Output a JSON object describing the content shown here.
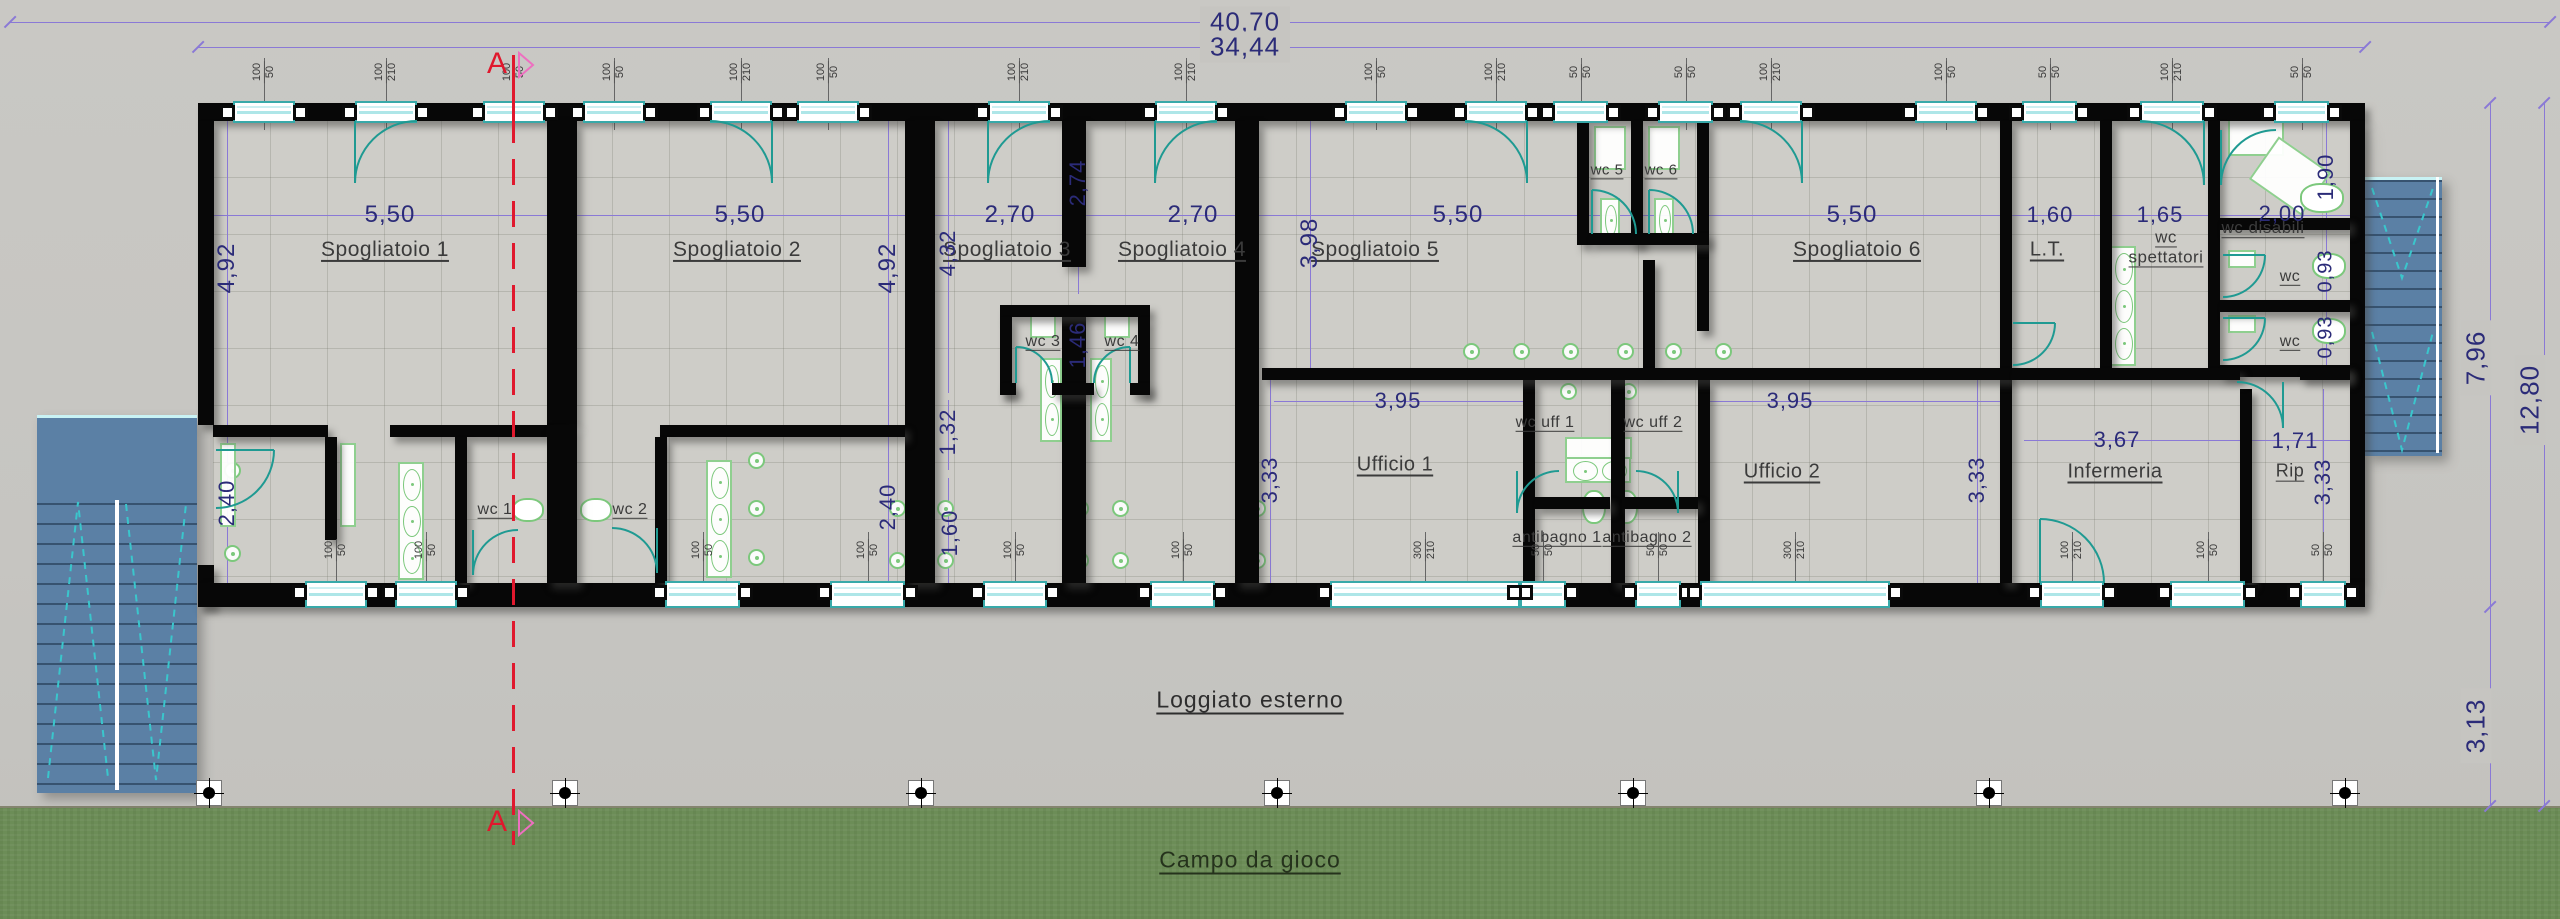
{
  "canvas": {
    "w": 2560,
    "h": 919
  },
  "palette": {
    "concrete": "#c6c5c1",
    "floor": "#cecdc8",
    "wall": "#070707",
    "dim_line": "#8a79d6",
    "dim_text": "#2b2b78",
    "window_frame": "#38a9a9",
    "door_teal": "#1f9a92",
    "fixture_green": "#7cc87c",
    "stair_blue": "#5b80a5",
    "grass": "#6c8d57",
    "section_red": "#e0182d",
    "flag_pink": "#ee6fc0"
  },
  "section": {
    "label": "A",
    "x": 513,
    "top_label_y": 64,
    "bottom_label_y": 822,
    "line_top": 55,
    "line_bottom": 845
  },
  "site": {
    "loggia_label": "Loggiato esterno",
    "loggia_x": 1250,
    "loggia_y": 700,
    "field_label": "Campo da gioco",
    "field_x": 1250,
    "field_y": 860,
    "grass_y": 806
  },
  "building": {
    "floor": [
      213,
      120,
      2139,
      463
    ]
  },
  "overall_dims": [
    {
      "t": "40,70",
      "x": 1245,
      "y": 22,
      "o": "h",
      "fs": 26,
      "bg": true
    },
    {
      "t": "34,44",
      "x": 1245,
      "y": 47,
      "o": "h",
      "fs": 26,
      "bg": true
    },
    {
      "t": "7,96",
      "x": 2476,
      "y": 358,
      "o": "v",
      "fs": 26,
      "bg": true
    },
    {
      "t": "12,80",
      "x": 2530,
      "y": 400,
      "o": "v",
      "fs": 26,
      "bg": true
    },
    {
      "t": "3,13",
      "x": 2476,
      "y": 726,
      "o": "v",
      "fs": 26,
      "bg": true
    }
  ],
  "dim_labels": [
    {
      "t": "5,50",
      "x": 390,
      "y": 215,
      "o": "h",
      "fs": 24
    },
    {
      "t": "5,50",
      "x": 740,
      "y": 215,
      "o": "h",
      "fs": 24
    },
    {
      "t": "2,70",
      "x": 1010,
      "y": 215,
      "o": "h",
      "fs": 24
    },
    {
      "t": "2,70",
      "x": 1193,
      "y": 215,
      "o": "h",
      "fs": 24
    },
    {
      "t": "5,50",
      "x": 1458,
      "y": 215,
      "o": "h",
      "fs": 24
    },
    {
      "t": "5,50",
      "x": 1852,
      "y": 215,
      "o": "h",
      "fs": 24
    },
    {
      "t": "1,60",
      "x": 2050,
      "y": 215,
      "o": "h",
      "fs": 22
    },
    {
      "t": "1,65",
      "x": 2160,
      "y": 215,
      "o": "h",
      "fs": 22
    },
    {
      "t": "2,00",
      "x": 2282,
      "y": 214,
      "o": "h",
      "fs": 22
    },
    {
      "t": "4,92",
      "x": 227,
      "y": 268,
      "o": "v",
      "fs": 24
    },
    {
      "t": "4,92",
      "x": 888,
      "y": 268,
      "o": "v",
      "fs": 24
    },
    {
      "t": "4,32",
      "x": 948,
      "y": 253,
      "o": "v",
      "fs": 22
    },
    {
      "t": "2,74",
      "x": 1078,
      "y": 183,
      "o": "v",
      "fs": 22
    },
    {
      "t": "1,46",
      "x": 1078,
      "y": 345,
      "o": "v",
      "fs": 22
    },
    {
      "t": "3,98",
      "x": 1310,
      "y": 243,
      "o": "v",
      "fs": 24
    },
    {
      "t": "1,90",
      "x": 2326,
      "y": 177,
      "o": "v",
      "fs": 22
    },
    {
      "t": "2,40",
      "x": 227,
      "y": 503,
      "o": "v",
      "fs": 22
    },
    {
      "t": "2,40",
      "x": 888,
      "y": 507,
      "o": "v",
      "fs": 22
    },
    {
      "t": "1,32",
      "x": 948,
      "y": 432,
      "o": "v",
      "fs": 22
    },
    {
      "t": "1,60",
      "x": 950,
      "y": 533,
      "o": "v",
      "fs": 22
    },
    {
      "t": "0,93",
      "x": 2326,
      "y": 271,
      "o": "v",
      "fs": 20
    },
    {
      "t": "0,93",
      "x": 2326,
      "y": 337,
      "o": "v",
      "fs": 20
    },
    {
      "t": "3,95",
      "x": 1398,
      "y": 401,
      "o": "h",
      "fs": 22
    },
    {
      "t": "3,95",
      "x": 1790,
      "y": 401,
      "o": "h",
      "fs": 22
    },
    {
      "t": "3,67",
      "x": 2117,
      "y": 440,
      "o": "h",
      "fs": 22
    },
    {
      "t": "1,71",
      "x": 2295,
      "y": 441,
      "o": "h",
      "fs": 22
    },
    {
      "t": "3,33",
      "x": 1270,
      "y": 480,
      "o": "v",
      "fs": 22
    },
    {
      "t": "3,33",
      "x": 1977,
      "y": 480,
      "o": "v",
      "fs": 22
    },
    {
      "t": "3,33",
      "x": 2323,
      "y": 482,
      "o": "v",
      "fs": 22
    }
  ],
  "dim_lines": [
    [
      10,
      22,
      2540,
      1
    ],
    [
      198,
      47,
      2167,
      1
    ],
    [
      213,
      215,
      2139,
      1
    ],
    [
      1274,
      401,
      249,
      1
    ],
    [
      1710,
      401,
      290,
      1
    ],
    [
      2024,
      440,
      326,
      1
    ],
    [
      227,
      121,
      1,
      304
    ],
    [
      227,
      437,
      1,
      146
    ],
    [
      888,
      121,
      1,
      304
    ],
    [
      888,
      437,
      1,
      146
    ],
    [
      948,
      121,
      1,
      272
    ],
    [
      948,
      400,
      1,
      70
    ],
    [
      948,
      478,
      1,
      105
    ],
    [
      1078,
      121,
      1,
      173
    ],
    [
      1078,
      305,
      1,
      90
    ],
    [
      1310,
      121,
      1,
      250
    ],
    [
      1270,
      380,
      1,
      203
    ],
    [
      1977,
      380,
      1,
      203
    ],
    [
      2323,
      389,
      1,
      194
    ],
    [
      2326,
      121,
      1,
      97
    ],
    [
      2326,
      230,
      1,
      70
    ],
    [
      2326,
      312,
      1,
      53
    ],
    [
      2490,
      103,
      1,
      504
    ],
    [
      2544,
      103,
      1,
      703
    ],
    [
      2490,
      607,
      1,
      199
    ]
  ],
  "ticks": [
    [
      10,
      22
    ],
    [
      2550,
      22
    ],
    [
      198,
      47
    ],
    [
      2365,
      47
    ],
    [
      2490,
      103
    ],
    [
      2490,
      607
    ],
    [
      2490,
      806
    ],
    [
      2544,
      103
    ],
    [
      2544,
      806
    ]
  ],
  "rooms": [
    {
      "label": "Spogliatoio 1",
      "x": 385,
      "y": 250,
      "fs": 21
    },
    {
      "label": "Spogliatoio 2",
      "x": 737,
      "y": 250,
      "fs": 21
    },
    {
      "label": "Spogliatoio 3",
      "x": 1007,
      "y": 250,
      "fs": 21
    },
    {
      "label": "Spogliatoio 4",
      "x": 1182,
      "y": 250,
      "fs": 21
    },
    {
      "label": "Spogliatoio 5",
      "x": 1375,
      "y": 250,
      "fs": 21
    },
    {
      "label": "Spogliatoio 6",
      "x": 1857,
      "y": 250,
      "fs": 21
    },
    {
      "label": "L.T.",
      "x": 2047,
      "y": 250,
      "fs": 20
    },
    {
      "label": "wc spettatori",
      "x": 2166,
      "y": 247,
      "fs": 17,
      "w": 95
    },
    {
      "label": "wc disabili",
      "x": 2263,
      "y": 228,
      "fs": 17
    },
    {
      "label": "wc",
      "x": 2290,
      "y": 277,
      "fs": 16
    },
    {
      "label": "wc",
      "x": 2290,
      "y": 342,
      "fs": 16
    },
    {
      "label": "Ufficio 1",
      "x": 1395,
      "y": 465,
      "fs": 20
    },
    {
      "label": "wc uff 1",
      "x": 1545,
      "y": 423,
      "fs": 16
    },
    {
      "label": "wc uff 2",
      "x": 1653,
      "y": 423,
      "fs": 16
    },
    {
      "label": "antibagno 1",
      "x": 1557,
      "y": 538,
      "fs": 16
    },
    {
      "label": "antibagno 2",
      "x": 1647,
      "y": 538,
      "fs": 16
    },
    {
      "label": "Ufficio 2",
      "x": 1782,
      "y": 472,
      "fs": 20
    },
    {
      "label": "Infermeria",
      "x": 2115,
      "y": 472,
      "fs": 20
    },
    {
      "label": "Rip",
      "x": 2290,
      "y": 471,
      "fs": 18
    },
    {
      "label": "wc 1",
      "x": 495,
      "y": 510,
      "fs": 16
    },
    {
      "label": "wc 2",
      "x": 630,
      "y": 510,
      "fs": 16
    },
    {
      "label": "wc 3",
      "x": 1043,
      "y": 342,
      "fs": 16
    },
    {
      "label": "wc 4",
      "x": 1122,
      "y": 342,
      "fs": 16
    },
    {
      "label": "wc 5",
      "x": 1607,
      "y": 170,
      "fs": 15
    },
    {
      "label": "wc 6",
      "x": 1661,
      "y": 170,
      "fs": 15
    }
  ],
  "walls": [
    [
      198,
      103,
      2167,
      18
    ],
    [
      198,
      121,
      16,
      304
    ],
    [
      198,
      565,
      16,
      42
    ],
    [
      2350,
      121,
      15,
      462
    ],
    [
      198,
      583,
      2167,
      24
    ],
    [
      547,
      121,
      30,
      304
    ],
    [
      905,
      121,
      30,
      462
    ],
    [
      1062,
      121,
      24,
      146
    ],
    [
      1062,
      305,
      24,
      278
    ],
    [
      1235,
      121,
      24,
      462
    ],
    [
      1577,
      121,
      12,
      124
    ],
    [
      1631,
      121,
      12,
      124
    ],
    [
      1697,
      121,
      12,
      210
    ],
    [
      2000,
      121,
      12,
      462
    ],
    [
      2100,
      121,
      12,
      247
    ],
    [
      2208,
      121,
      12,
      247
    ],
    [
      2240,
      389,
      12,
      194
    ],
    [
      1523,
      380,
      12,
      203
    ],
    [
      1611,
      380,
      14,
      203
    ],
    [
      1698,
      380,
      12,
      203
    ],
    [
      1643,
      260,
      12,
      110
    ],
    [
      1589,
      233,
      120,
      12
    ],
    [
      2220,
      218,
      130,
      12
    ],
    [
      2220,
      300,
      130,
      12
    ],
    [
      2220,
      365,
      130,
      12
    ],
    [
      1262,
      368,
      750,
      12
    ],
    [
      2012,
      368,
      228,
      12
    ],
    [
      2300,
      368,
      50,
      12
    ],
    [
      1535,
      497,
      75,
      12
    ],
    [
      1622,
      497,
      76,
      12
    ],
    [
      213,
      425,
      115,
      12
    ],
    [
      390,
      425,
      170,
      12
    ],
    [
      660,
      425,
      245,
      12
    ],
    [
      455,
      437,
      12,
      146
    ],
    [
      655,
      437,
      12,
      146
    ],
    [
      547,
      425,
      30,
      158
    ],
    [
      325,
      437,
      12,
      103
    ],
    [
      1000,
      305,
      150,
      12
    ],
    [
      1000,
      317,
      12,
      78
    ],
    [
      1138,
      317,
      12,
      78
    ],
    [
      1000,
      383,
      16,
      12
    ],
    [
      1052,
      383,
      42,
      12
    ],
    [
      1130,
      383,
      20,
      12
    ]
  ],
  "windows_top": [
    {
      "x": 233,
      "w": 62,
      "label": "100|50"
    },
    {
      "x": 355,
      "w": 62,
      "label": "100|210",
      "arc": "dl"
    },
    {
      "x": 483,
      "w": 62,
      "label": "100|50"
    },
    {
      "x": 583,
      "w": 62,
      "label": "100|50"
    },
    {
      "x": 710,
      "w": 62,
      "label": "100|210",
      "arc": "dr"
    },
    {
      "x": 797,
      "w": 62,
      "label": "100|50"
    },
    {
      "x": 988,
      "w": 62,
      "label": "100|210",
      "arc": "dl"
    },
    {
      "x": 1155,
      "w": 62,
      "label": "100|210",
      "arc": "dl"
    },
    {
      "x": 1345,
      "w": 62,
      "label": "100|50"
    },
    {
      "x": 1465,
      "w": 62,
      "label": "100|210",
      "arc": "dr"
    },
    {
      "x": 1553,
      "w": 55,
      "label": "50|50"
    },
    {
      "x": 1658,
      "w": 55,
      "label": "50|50"
    },
    {
      "x": 1740,
      "w": 62,
      "label": "100|210",
      "arc": "dr"
    },
    {
      "x": 1915,
      "w": 62,
      "label": "100|50"
    },
    {
      "x": 2022,
      "w": 55,
      "label": "50|50"
    },
    {
      "x": 2140,
      "w": 64,
      "label": "100|210",
      "arc": "dr"
    },
    {
      "x": 2274,
      "w": 55,
      "label": "50|50"
    }
  ],
  "windows_bottom": [
    {
      "x": 305,
      "w": 62,
      "label": "100|50"
    },
    {
      "x": 395,
      "w": 62,
      "label": "100|50"
    },
    {
      "x": 665,
      "w": 75,
      "label": "100|50"
    },
    {
      "x": 830,
      "w": 75,
      "label": "100|50"
    },
    {
      "x": 983,
      "w": 64,
      "label": "100|50"
    },
    {
      "x": 1150,
      "w": 65,
      "label": "100|50"
    },
    {
      "x": 1330,
      "w": 190,
      "label": "300|210"
    },
    {
      "x": 1520,
      "w": 46,
      "label": "50|50"
    },
    {
      "x": 1635,
      "w": 46,
      "label": "50|50"
    },
    {
      "x": 1700,
      "w": 190,
      "label": "300|210"
    },
    {
      "x": 2040,
      "w": 64,
      "label": "100|210",
      "arc": "ul"
    },
    {
      "x": 2170,
      "w": 75,
      "label": "100|50"
    },
    {
      "x": 2300,
      "w": 46,
      "label": "50|50"
    }
  ],
  "doors": [
    [
      216,
      450,
      58,
      "rt"
    ],
    [
      473,
      530,
      45,
      "dl"
    ],
    [
      612,
      528,
      45,
      "dr"
    ],
    [
      1016,
      347,
      36,
      "ul"
    ],
    [
      1094,
      347,
      36,
      "ur"
    ],
    [
      1592,
      190,
      44,
      "ul"
    ],
    [
      1649,
      190,
      44,
      "ul"
    ],
    [
      1517,
      471,
      42,
      "dl"
    ],
    [
      1636,
      471,
      42,
      "dr"
    ],
    [
      2237,
      382,
      46,
      "dr"
    ],
    [
      2013,
      323,
      42,
      "rt"
    ],
    [
      2221,
      130,
      55,
      "dl"
    ],
    [
      2223,
      255,
      42,
      "rt"
    ],
    [
      2223,
      318,
      42,
      "rt"
    ]
  ],
  "fixtures": {
    "sinks": [
      {
        "x": 398,
        "y": 462,
        "w": 26,
        "h": 118,
        "n": 3
      },
      {
        "x": 706,
        "y": 460,
        "w": 26,
        "h": 118,
        "n": 3
      },
      {
        "x": 1040,
        "y": 358,
        "w": 22,
        "h": 84,
        "n": 2
      },
      {
        "x": 1090,
        "y": 358,
        "w": 22,
        "h": 84,
        "n": 2
      },
      {
        "x": 2110,
        "y": 246,
        "w": 26,
        "h": 120,
        "n": 3
      },
      {
        "x": 1600,
        "y": 198,
        "w": 20,
        "h": 44,
        "n": 1
      },
      {
        "x": 1654,
        "y": 198,
        "w": 20,
        "h": 44,
        "n": 1
      },
      {
        "x": 1565,
        "y": 455,
        "w": 66,
        "h": 28,
        "n": 2,
        "dir": "h"
      }
    ],
    "showers": [
      [
        232,
        470
      ],
      [
        232,
        553
      ],
      [
        756,
        460
      ],
      [
        756,
        508
      ],
      [
        756,
        557
      ],
      [
        897,
        508
      ],
      [
        945,
        508
      ],
      [
        897,
        560
      ],
      [
        945,
        560
      ],
      [
        1080,
        508
      ],
      [
        1120,
        508
      ],
      [
        1080,
        560
      ],
      [
        1120,
        560
      ],
      [
        1257,
        508
      ],
      [
        1257,
        560
      ],
      [
        1471,
        351
      ],
      [
        1521,
        351
      ],
      [
        1570,
        351
      ],
      [
        1625,
        351
      ],
      [
        1673,
        351
      ],
      [
        1723,
        351
      ],
      [
        1568,
        391
      ],
      [
        1628,
        391
      ]
    ],
    "trays": [
      [
        1030,
        312,
        26,
        26
      ],
      [
        1104,
        312,
        26,
        26
      ],
      [
        1594,
        126,
        32,
        44
      ],
      [
        1648,
        126,
        32,
        44
      ],
      [
        1565,
        437,
        67,
        22
      ],
      [
        2228,
        110,
        56,
        46
      ],
      [
        2258,
        150,
        64,
        52,
        35
      ],
      [
        220,
        443,
        16,
        84
      ],
      [
        340,
        443,
        16,
        84
      ],
      [
        2228,
        250,
        28,
        18
      ],
      [
        2228,
        315,
        28,
        18
      ]
    ],
    "toilets": [
      [
        512,
        498,
        32,
        24
      ],
      [
        580,
        498,
        32,
        24
      ],
      [
        1582,
        490,
        24,
        34
      ],
      [
        1614,
        490,
        24,
        34
      ],
      [
        2312,
        253,
        34,
        26
      ],
      [
        2312,
        318,
        34,
        26
      ],
      [
        2300,
        183,
        44,
        30
      ]
    ]
  },
  "stairs": {
    "left": {
      "x": 37,
      "y": 415,
      "w": 160,
      "h": 375,
      "landing": 85,
      "steps": 14,
      "chevrons": [
        {
          "apex": [
            78,
            502
          ],
          "ends": [
            [
              48,
              778
            ],
            [
              108,
              778
            ]
          ]
        },
        {
          "apex": [
            156,
            780
          ],
          "ends": [
            [
              126,
              504
            ],
            [
              186,
              504
            ]
          ]
        }
      ]
    },
    "right": {
      "x": 2365,
      "y": 177,
      "w": 77,
      "h": 276,
      "landing": 0,
      "steps": 15,
      "chevrons": [
        {
          "apex": [
            2402,
            278
          ],
          "ends": [
            [
              2372,
              188
            ],
            [
              2433,
              188
            ]
          ]
        },
        {
          "apex": [
            2402,
            450
          ],
          "ends": [
            [
              2372,
              332
            ],
            [
              2433,
              332
            ]
          ]
        }
      ]
    }
  },
  "markers": {
    "y": 793,
    "xs": [
      209,
      565,
      921,
      1277,
      1633,
      1989,
      2345
    ]
  }
}
